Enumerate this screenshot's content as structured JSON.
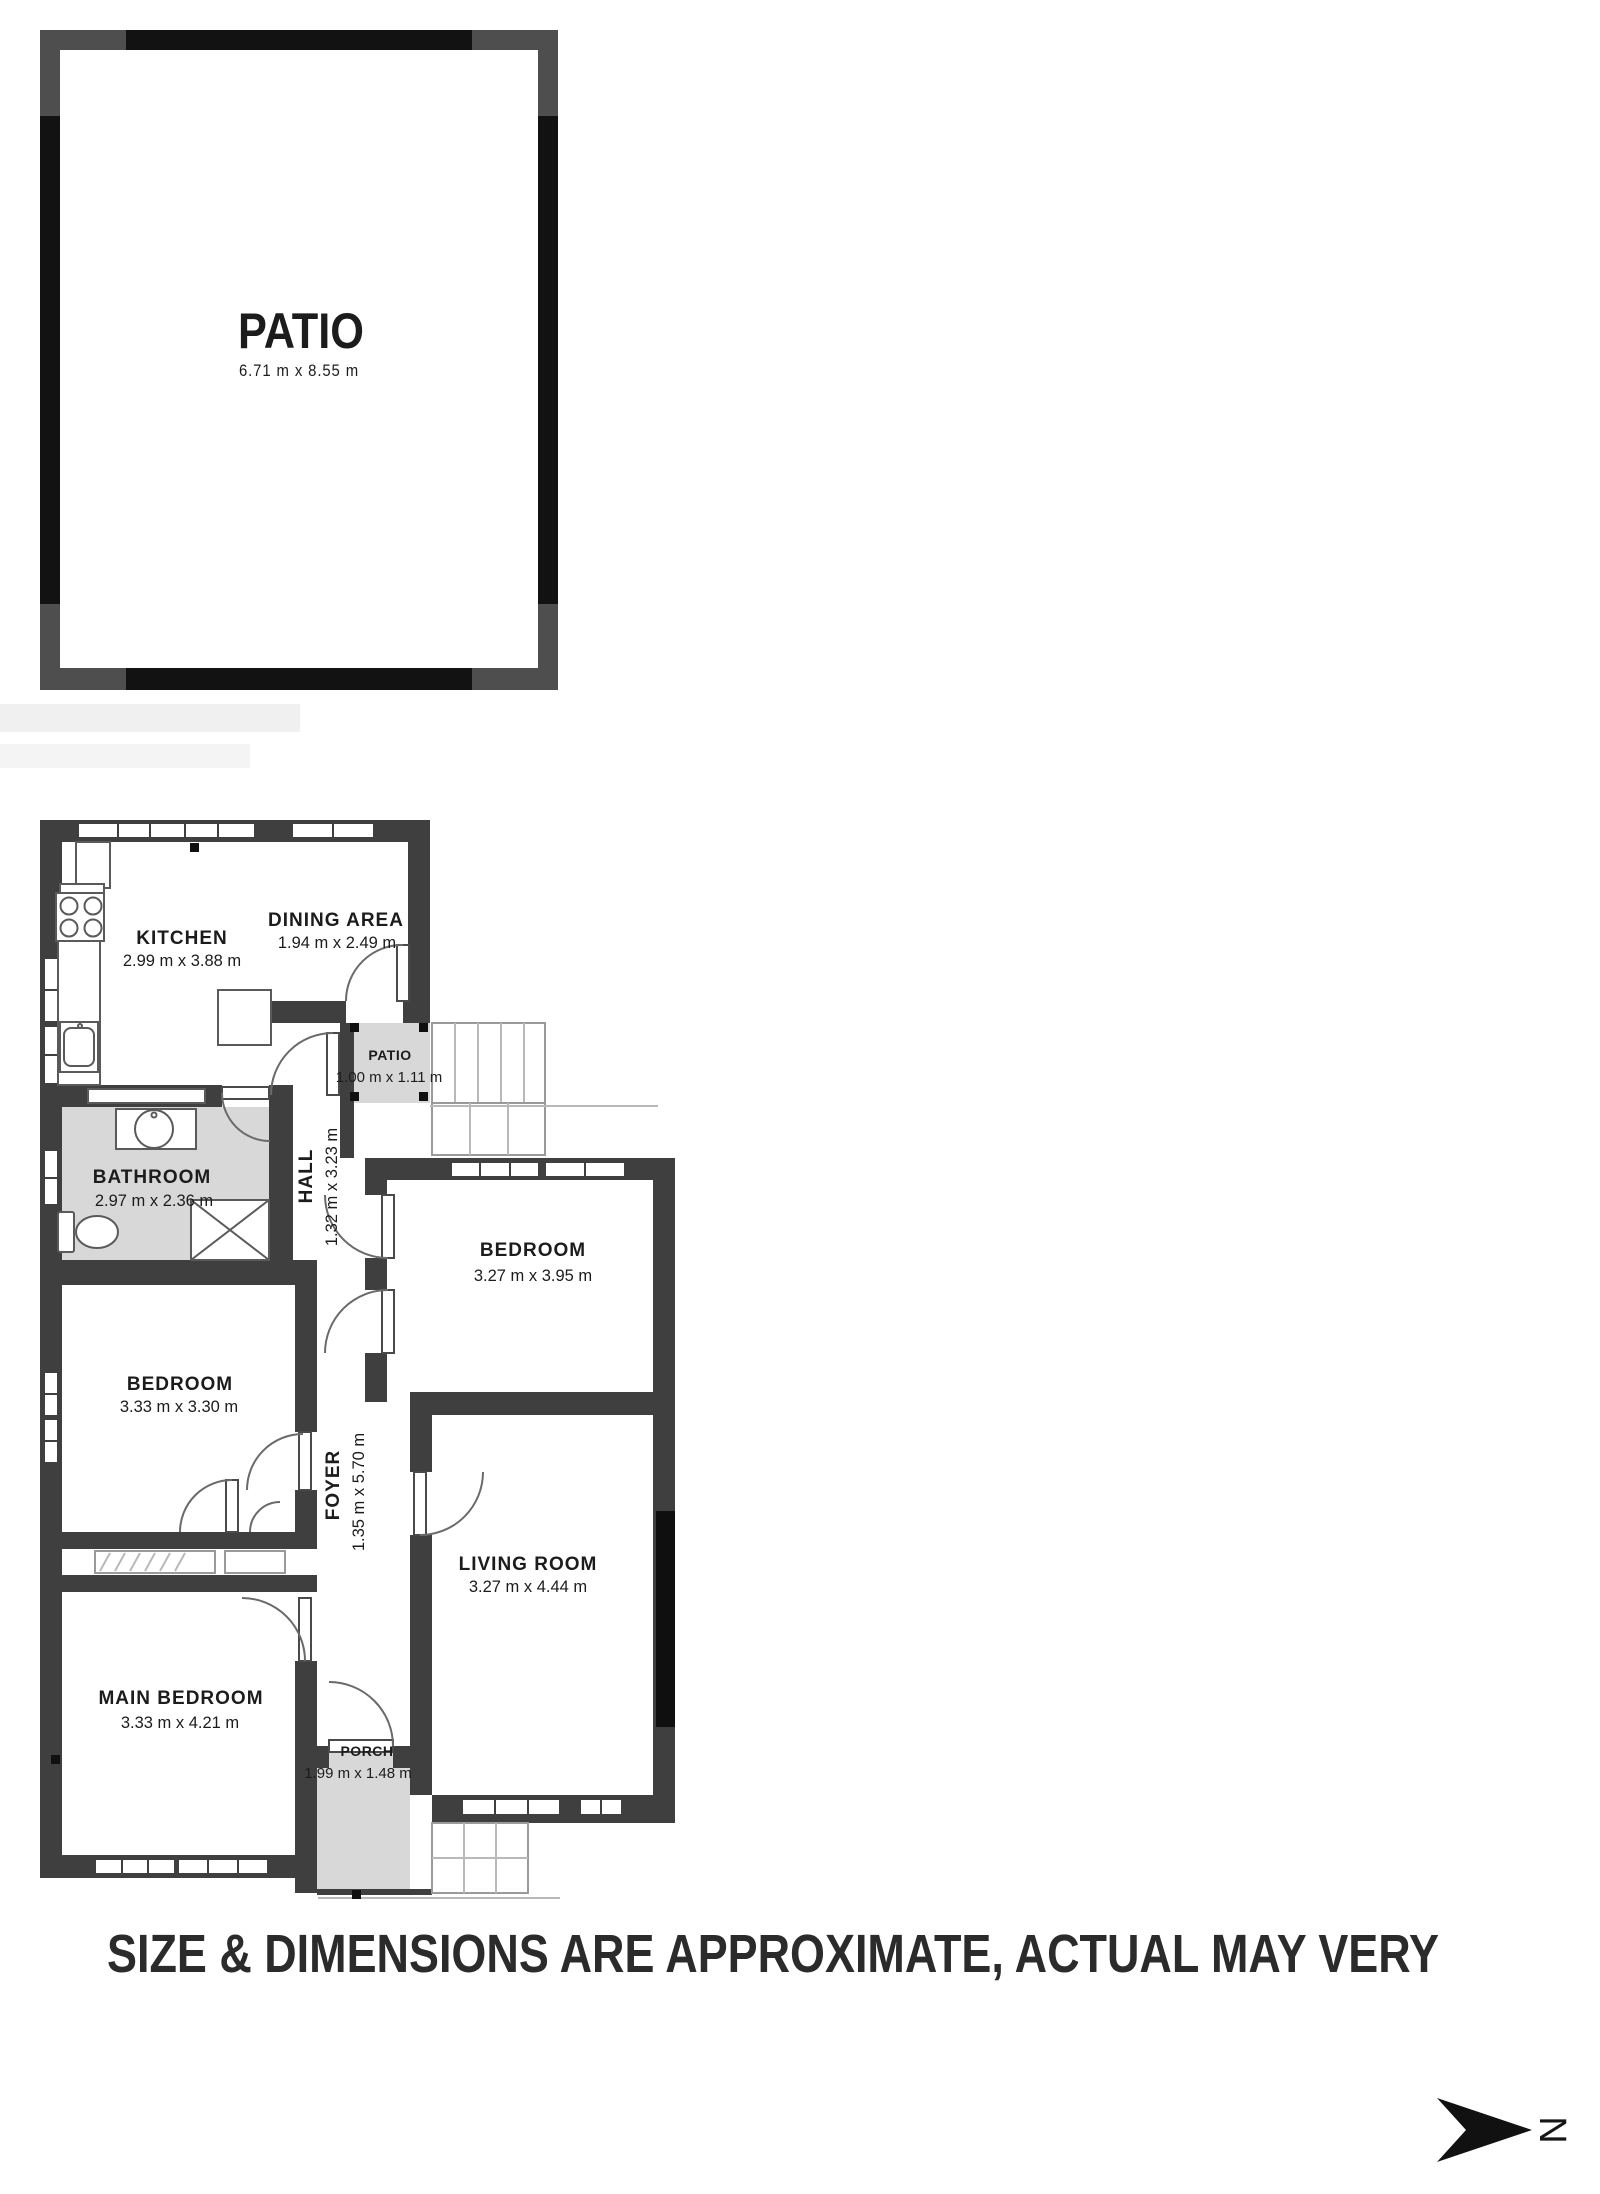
{
  "top_patio": {
    "name": "PATIO",
    "dims": "6.71 m x 8.55 m"
  },
  "rooms": {
    "kitchen": {
      "name": "KITCHEN",
      "dims": "2.99 m x 3.88 m"
    },
    "dining": {
      "name": "DINING AREA",
      "dims": "1.94 m x 2.49 m"
    },
    "patio_small": {
      "name": "PATIO",
      "dims": "1.00 m x 1.11 m"
    },
    "bathroom": {
      "name": "BATHROOM",
      "dims": "2.97 m x 2.36 m"
    },
    "hall": {
      "name": "HALL",
      "dims": "1.32 m x 3.23 m"
    },
    "bedroom_right": {
      "name": "BEDROOM",
      "dims": "3.27 m x 3.95 m"
    },
    "bedroom_left": {
      "name": "BEDROOM",
      "dims": "3.33 m x 3.30 m"
    },
    "foyer": {
      "name": "FOYER",
      "dims": "1.35 m x 5.70 m"
    },
    "living_room": {
      "name": "LIVING ROOM",
      "dims": "3.27 m x 4.44 m"
    },
    "main_bedroom": {
      "name": "MAIN BEDROOM",
      "dims": "3.33 m x 4.21 m"
    },
    "porch": {
      "name": "PORCH",
      "dims": "1.99 m x 1.48 m"
    }
  },
  "disclaimer": "SIZE & DIMENSIONS ARE APPROXIMATE, ACTUAL MAY VERY",
  "compass": {
    "label": "N"
  },
  "colors": {
    "wall": "#3f3f3f",
    "outer_wall": "#121212",
    "corner_block": "#4e4e4e",
    "room_fill": "#d8d8d8",
    "text": "#1c1c1c"
  }
}
